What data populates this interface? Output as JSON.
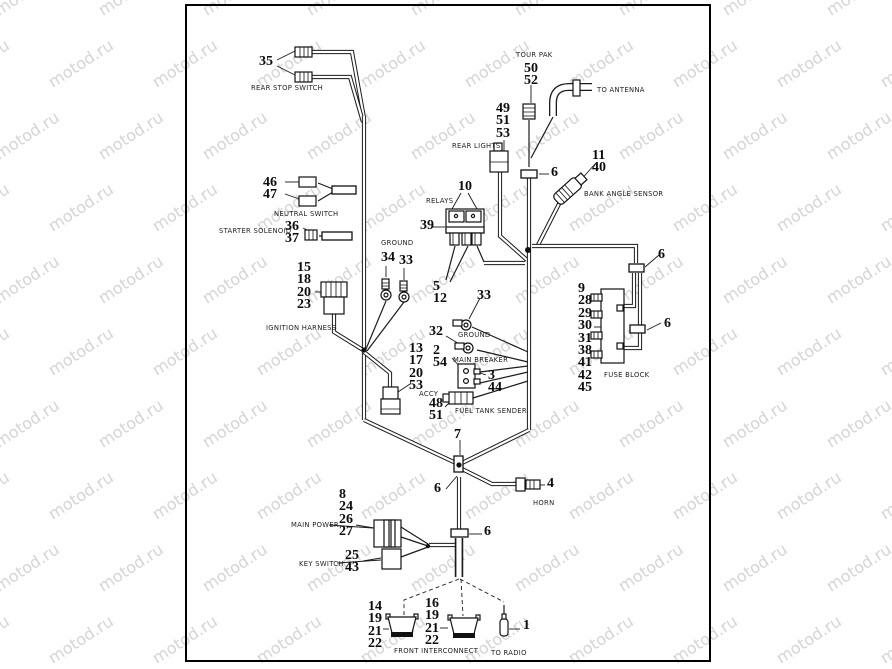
{
  "watermark": {
    "text": "motod.ru",
    "color": "#d4d4d4"
  },
  "diagram": {
    "title": "wiring harness parts diagram",
    "part_numbers": [
      {
        "name": "rear-stop-switch",
        "x": 259,
        "y": 56,
        "lines": [
          "35"
        ]
      },
      {
        "name": "tour-pak",
        "x": 524,
        "y": 63,
        "lines": [
          "50",
          "52"
        ]
      },
      {
        "name": "rear-lights",
        "x": 496,
        "y": 103,
        "lines": [
          "49",
          "51",
          "53"
        ]
      },
      {
        "name": "conn-6-trunk-top",
        "x": 551,
        "y": 167,
        "lines": [
          "6"
        ]
      },
      {
        "name": "bank-angle-sensor",
        "x": 592,
        "y": 150,
        "lines": [
          "11",
          "40"
        ]
      },
      {
        "name": "relays",
        "x": 458,
        "y": 181,
        "lines": [
          "10"
        ]
      },
      {
        "name": "relay-block",
        "x": 420,
        "y": 220,
        "lines": [
          "39"
        ]
      },
      {
        "name": "neutral-switch",
        "x": 263,
        "y": 177,
        "lines": [
          "46",
          "47"
        ]
      },
      {
        "name": "starter-solenoid",
        "x": 285,
        "y": 221,
        "lines": [
          "36",
          "37"
        ]
      },
      {
        "name": "ground-left-a",
        "x": 381,
        "y": 252,
        "lines": [
          "34"
        ]
      },
      {
        "name": "ground-left-b",
        "x": 399,
        "y": 255,
        "lines": [
          "33"
        ]
      },
      {
        "name": "ignition-harness",
        "x": 297,
        "y": 262,
        "lines": [
          "15",
          "18",
          "20",
          "23"
        ]
      },
      {
        "name": "relay-connectors",
        "x": 433,
        "y": 281,
        "lines": [
          "5",
          "12"
        ]
      },
      {
        "name": "conn-6-right",
        "x": 658,
        "y": 249,
        "lines": [
          "6"
        ]
      },
      {
        "name": "fuse-block",
        "x": 578,
        "y": 283,
        "lines": [
          "9",
          "28",
          "29",
          "30",
          "31",
          "38",
          "41",
          "42",
          "45"
        ]
      },
      {
        "name": "conn-6-fuse",
        "x": 664,
        "y": 318,
        "lines": [
          "6"
        ]
      },
      {
        "name": "ground-center-a",
        "x": 477,
        "y": 290,
        "lines": [
          "33"
        ]
      },
      {
        "name": "ground-center-b",
        "x": 429,
        "y": 326,
        "lines": [
          "32"
        ]
      },
      {
        "name": "main-breaker",
        "x": 433,
        "y": 345,
        "lines": [
          "2",
          "54"
        ]
      },
      {
        "name": "main-breaker-conn",
        "x": 488,
        "y": 370,
        "lines": [
          "3",
          "44"
        ]
      },
      {
        "name": "accy",
        "x": 409,
        "y": 343,
        "lines": [
          "13",
          "17",
          "20",
          "53"
        ]
      },
      {
        "name": "fuel-tank-sender",
        "x": 429,
        "y": 398,
        "lines": [
          "48",
          "51"
        ]
      },
      {
        "name": "junction",
        "x": 454,
        "y": 429,
        "lines": [
          "7"
        ]
      },
      {
        "name": "conn-6-junction",
        "x": 434,
        "y": 483,
        "lines": [
          "6"
        ]
      },
      {
        "name": "horn",
        "x": 547,
        "y": 478,
        "lines": [
          "4"
        ]
      },
      {
        "name": "main-power",
        "x": 339,
        "y": 489,
        "lines": [
          "8",
          "24",
          "26",
          "27"
        ]
      },
      {
        "name": "key-switch",
        "x": 345,
        "y": 550,
        "lines": [
          "25",
          "43"
        ]
      },
      {
        "name": "conn-6-lower",
        "x": 484,
        "y": 526,
        "lines": [
          "6"
        ]
      },
      {
        "name": "front-interconnect-left",
        "x": 368,
        "y": 601,
        "lines": [
          "14",
          "19",
          "21",
          "22"
        ]
      },
      {
        "name": "front-interconnect-right",
        "x": 425,
        "y": 598,
        "lines": [
          "16",
          "19",
          "21",
          "22"
        ]
      },
      {
        "name": "to-radio",
        "x": 523,
        "y": 620,
        "lines": [
          "1"
        ]
      }
    ],
    "labels": [
      {
        "name": "rear-stop-switch",
        "x": 251,
        "y": 84,
        "text": "REAR STOP SWITCH"
      },
      {
        "name": "tour-pak",
        "x": 516,
        "y": 51,
        "text": "TOUR PAK"
      },
      {
        "name": "to-antenna",
        "x": 597,
        "y": 86,
        "text": "TO ANTENNA"
      },
      {
        "name": "rear-lights",
        "x": 452,
        "y": 142,
        "text": "REAR LIGHTS"
      },
      {
        "name": "bank-angle-sensor",
        "x": 584,
        "y": 190,
        "text": "BANK ANGLE SENSOR"
      },
      {
        "name": "relays",
        "x": 426,
        "y": 197,
        "text": "RELAYS"
      },
      {
        "name": "neutral-switch",
        "x": 274,
        "y": 210,
        "text": "NEUTRAL SWITCH"
      },
      {
        "name": "starter-solenoid",
        "x": 219,
        "y": 227,
        "text": "STARTER SOLENOID"
      },
      {
        "name": "ground-left",
        "x": 381,
        "y": 239,
        "text": "GROUND"
      },
      {
        "name": "ignition-harness",
        "x": 266,
        "y": 324,
        "text": "IGNITION HARNESS"
      },
      {
        "name": "ground-center",
        "x": 458,
        "y": 331,
        "text": "GROUND"
      },
      {
        "name": "main-breaker",
        "x": 453,
        "y": 356,
        "text": "MAIN BREAKER"
      },
      {
        "name": "accy",
        "x": 419,
        "y": 390,
        "text": "ACCY"
      },
      {
        "name": "fuel-tank-sender",
        "x": 455,
        "y": 407,
        "text": "FUEL TANK SENDER"
      },
      {
        "name": "fuse-block",
        "x": 604,
        "y": 371,
        "text": "FUSE BLOCK"
      },
      {
        "name": "horn",
        "x": 533,
        "y": 499,
        "text": "HORN"
      },
      {
        "name": "main-power",
        "x": 291,
        "y": 521,
        "text": "MAIN POWER"
      },
      {
        "name": "key-switch",
        "x": 299,
        "y": 560,
        "text": "KEY SWITCH"
      },
      {
        "name": "front-interconnect",
        "x": 394,
        "y": 647,
        "text": "FRONT INTERCONNECT"
      },
      {
        "name": "to-radio",
        "x": 491,
        "y": 649,
        "text": "TO RADIO"
      }
    ]
  }
}
